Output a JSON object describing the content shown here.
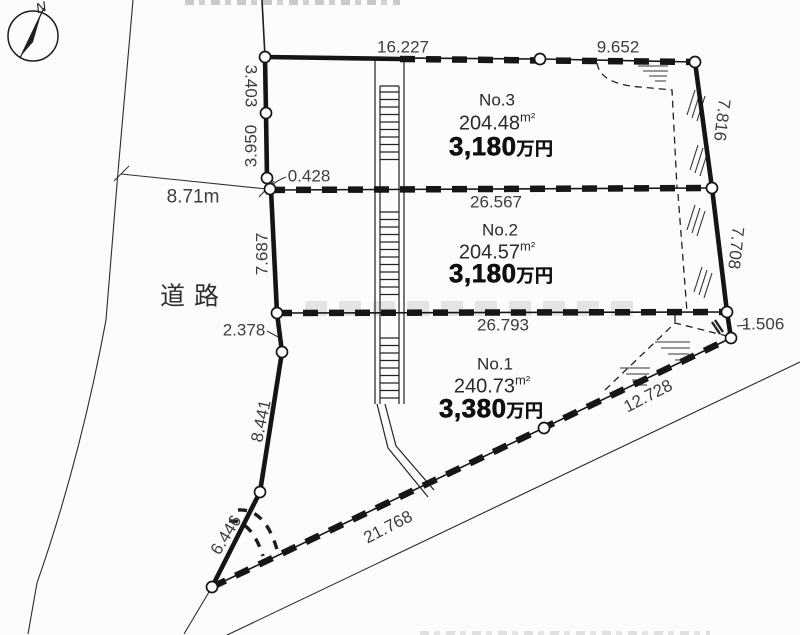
{
  "compass": {
    "north_label": "N"
  },
  "road": {
    "label": "道路",
    "width_dimension": "8.71m"
  },
  "plots": [
    {
      "id": "No.3",
      "area_value": "204.48",
      "area_unit": "m²",
      "price_number": "3,180",
      "price_unit": "万円"
    },
    {
      "id": "No.2",
      "area_value": "204.57",
      "area_unit": "m²",
      "price_number": "3,180",
      "price_unit": "万円"
    },
    {
      "id": "No.1",
      "area_value": "240.73",
      "area_unit": "m²",
      "price_number": "3,380",
      "price_unit": "万円"
    }
  ],
  "dims": {
    "top_edge_left": "16.227",
    "top_edge_right": "9.652",
    "left_a": "3.403",
    "left_b": "3.950",
    "left_jog": "0.428",
    "no3_no2_boundary": "26.567",
    "left_c": "7.687",
    "left_d": "2.378",
    "no2_no1_boundary": "26.793",
    "right_a": "7.816",
    "right_b": "7.708",
    "right_c": "1.506",
    "southeast_edge": "12.728",
    "south_edge": "21.768",
    "left_e": "8.441",
    "left_f": "6.446"
  }
}
